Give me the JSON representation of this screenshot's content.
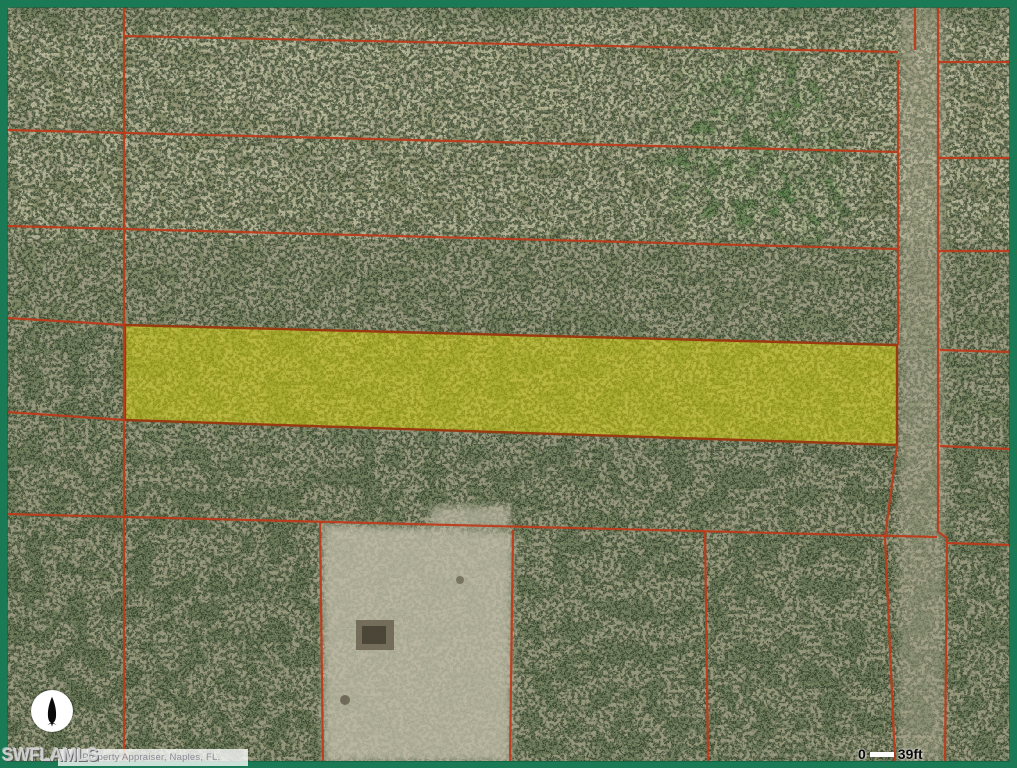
{
  "map": {
    "watermark": "SWFLAMLS",
    "attribution": "nty Property Appraiser, Naples, FL.",
    "scale_bar": {
      "start": "0",
      "end": "39ft"
    },
    "compass": {
      "icon": "north-arrow"
    },
    "colors": {
      "frame_border": "#1a7a55",
      "parcel_line": "#c03a1a",
      "highlight_fill": "#d9d606",
      "highlight_border": "#9a3a10",
      "cleared_land": "#c2beaa",
      "forest_base": "#75815f",
      "top_band": "#a29878",
      "scale_text": "#0a0a0a"
    }
  }
}
